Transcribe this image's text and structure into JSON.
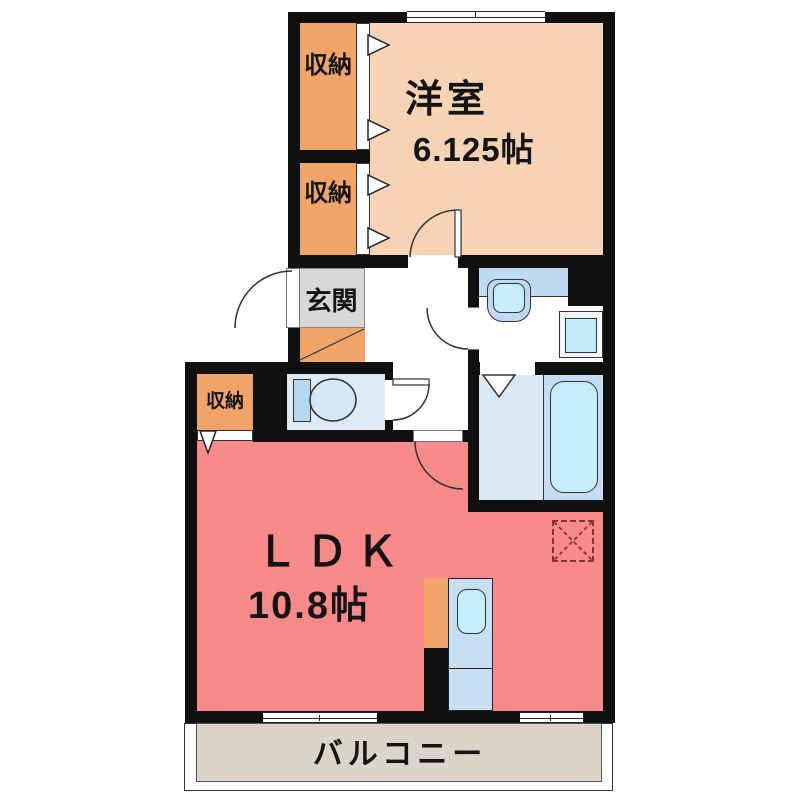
{
  "floorplan": {
    "type": "apartment-madori",
    "rooms": {
      "western_room": {
        "name": "洋室",
        "size": "6.125帖"
      },
      "ldk": {
        "name": "ＬＤＫ",
        "size": "10.8帖"
      },
      "entrance": {
        "name": "玄関"
      },
      "closet_top": {
        "name": "収納"
      },
      "closet_mid": {
        "name": "収納"
      },
      "closet_ldk": {
        "name": "収納"
      },
      "balcony": {
        "name": "バルコニー"
      }
    },
    "fixtures": [
      "toilet",
      "wash-basin",
      "washing-machine-pan",
      "bathtub",
      "kitchen-sink",
      "refrigerator-space",
      "shoe-cabinet"
    ],
    "colors": {
      "wall": "#101010",
      "western_room_floor": "#F5D3B4",
      "closet_floor": "#F0A468",
      "ldk_floor": "#F98A8A",
      "entrance_floor": "#D8D8D8",
      "balcony_floor": "#DBD4C8",
      "counter_blue": "#BFD9F2",
      "fixture_cyan": "#C4EEFA",
      "bathroom_floor_left": "#DBE8F6",
      "bathroom_floor_right": "#C6DCF0",
      "toilet_floor": "#DFEAF7",
      "refrigerator_dash": "#8B3030"
    }
  }
}
